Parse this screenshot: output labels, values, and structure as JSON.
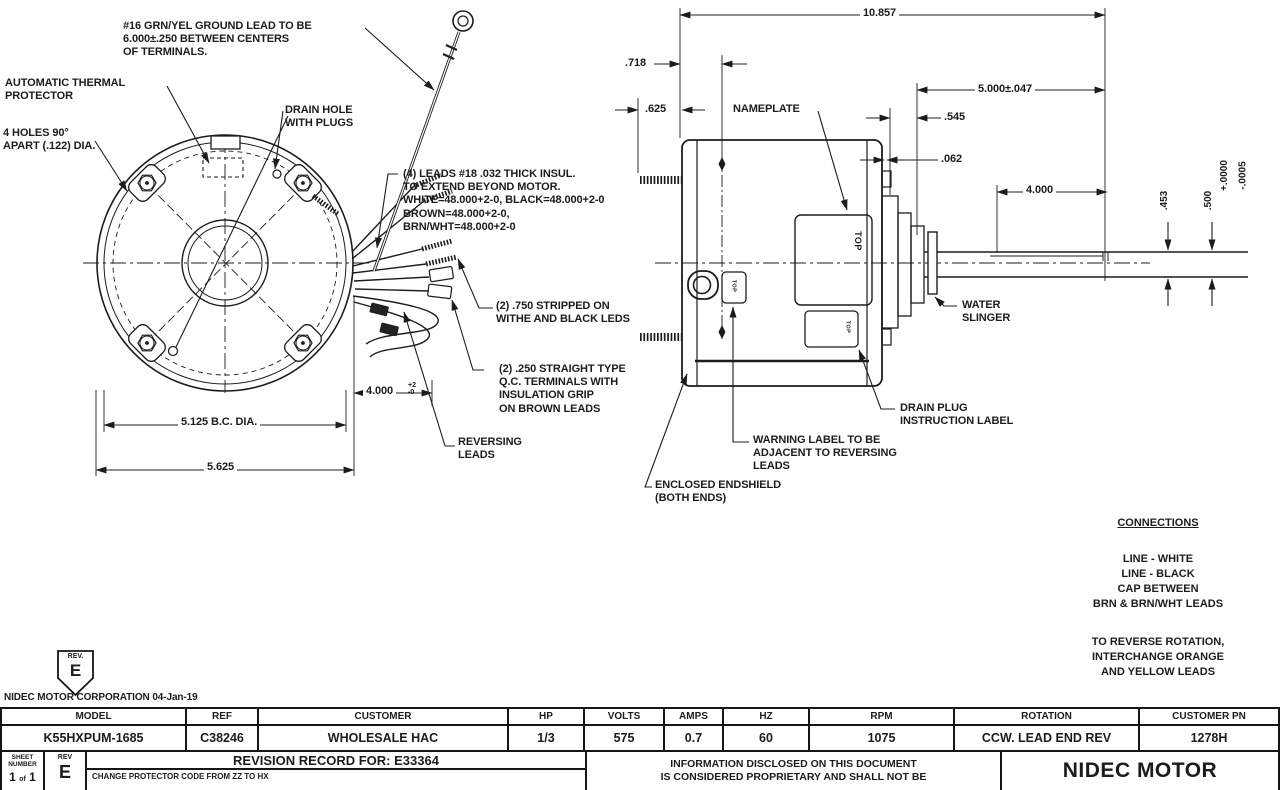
{
  "front_view": {
    "ground_note": "#16 GRN/YEL GROUND LEAD TO BE\n6.000±.250 BETWEEN CENTERS\nOF TERMINALS.",
    "thermal_note": "AUTOMATIC THERMAL\nPROTECTOR",
    "holes_note": "4 HOLES 90°\nAPART (.122) DIA.",
    "drain_note": "DRAIN HOLE\nWITH PLUGS",
    "leads_note": "(4) LEADS #18 .032 THICK INSUL.\nTO EXTEND BEYOND MOTOR.\nWHITE=48.000+2-0, BLACK=48.000+2-0\nBROWN=48.000+2-0,\nBRN/WHT=48.000+2-0",
    "stripped_note": "(2) .750 STRIPPED ON\nWITHE AND BLACK LEDS",
    "qc_note": "(2) .250 STRAIGHT TYPE\nQ.C. TERMINALS WITH\nINSULATION GRIP\nON BROWN LEADS",
    "reversing_note": "REVERSING\nLEADS",
    "dim_bc": "5.125  B.C. DIA.",
    "dim_od": "5.625",
    "dim_lead": "4.000",
    "dim_lead_tol": "+2\n-0"
  },
  "side_view": {
    "nameplate": "NAMEPLATE",
    "top_label": "TOP",
    "water_slinger": "WATER\nSLINGER",
    "drain_label": "DRAIN PLUG\nINSTRUCTION LABEL",
    "warning_label": "WARNING LABEL TO BE\nADJACENT TO REVERSING\nLEADS",
    "endshield_label": "ENCLOSED ENDSHIELD\n(BOTH ENDS)",
    "dim_10857": "10.857",
    "dim_718": ".718",
    "dim_625": ".625",
    "dim_5000": "5.000±.047",
    "dim_545": ".545",
    "dim_062": ".062",
    "dim_4000": "4.000",
    "dim_453": ".453",
    "dim_500": ".500",
    "tol_plus": "+.0000",
    "tol_minus": "-.0005"
  },
  "connections": {
    "title": "CONNECTIONS",
    "lines": "LINE - WHITE\nLINE - BLACK\nCAP BETWEEN\nBRN & BRN/WHT LEADS",
    "note": "TO REVERSE ROTATION,\nINTERCHANGE ORANGE\nAND YELLOW LEADS"
  },
  "title_block": {
    "badge_label": "REV.",
    "badge_value": "E",
    "company_line": "NIDEC MOTOR CORPORATION 04-Jan-19",
    "columns": [
      {
        "label": "MODEL",
        "value": "K55HXPUM-1685"
      },
      {
        "label": "REF",
        "value": "C38246"
      },
      {
        "label": "CUSTOMER",
        "value": "WHOLESALE HAC"
      },
      {
        "label": "HP",
        "value": "1/3"
      },
      {
        "label": "VOLTS",
        "value": "575"
      },
      {
        "label": "AMPS",
        "value": "0.7"
      },
      {
        "label": "HZ",
        "value": "60"
      },
      {
        "label": "RPM",
        "value": "1075"
      },
      {
        "label": "ROTATION",
        "value": "CCW. LEAD END REV"
      },
      {
        "label": "CUSTOMER PN",
        "value": "1278H"
      }
    ],
    "sheet_label": "SHEET\nNUMBER",
    "sheet_n1": "1",
    "sheet_of": "of",
    "sheet_n2": "1",
    "rev_label": "REV",
    "rev_value": "E",
    "revision_title": "REVISION RECORD FOR: E33364",
    "change_note": "CHANGE PROTECTOR CODE FROM ZZ TO HX",
    "info_text": "INFORMATION DISCLOSED ON THIS DOCUMENT\nIS CONSIDERED PROPRIETARY AND SHALL NOT BE",
    "brand": "NIDEC MOTOR"
  }
}
